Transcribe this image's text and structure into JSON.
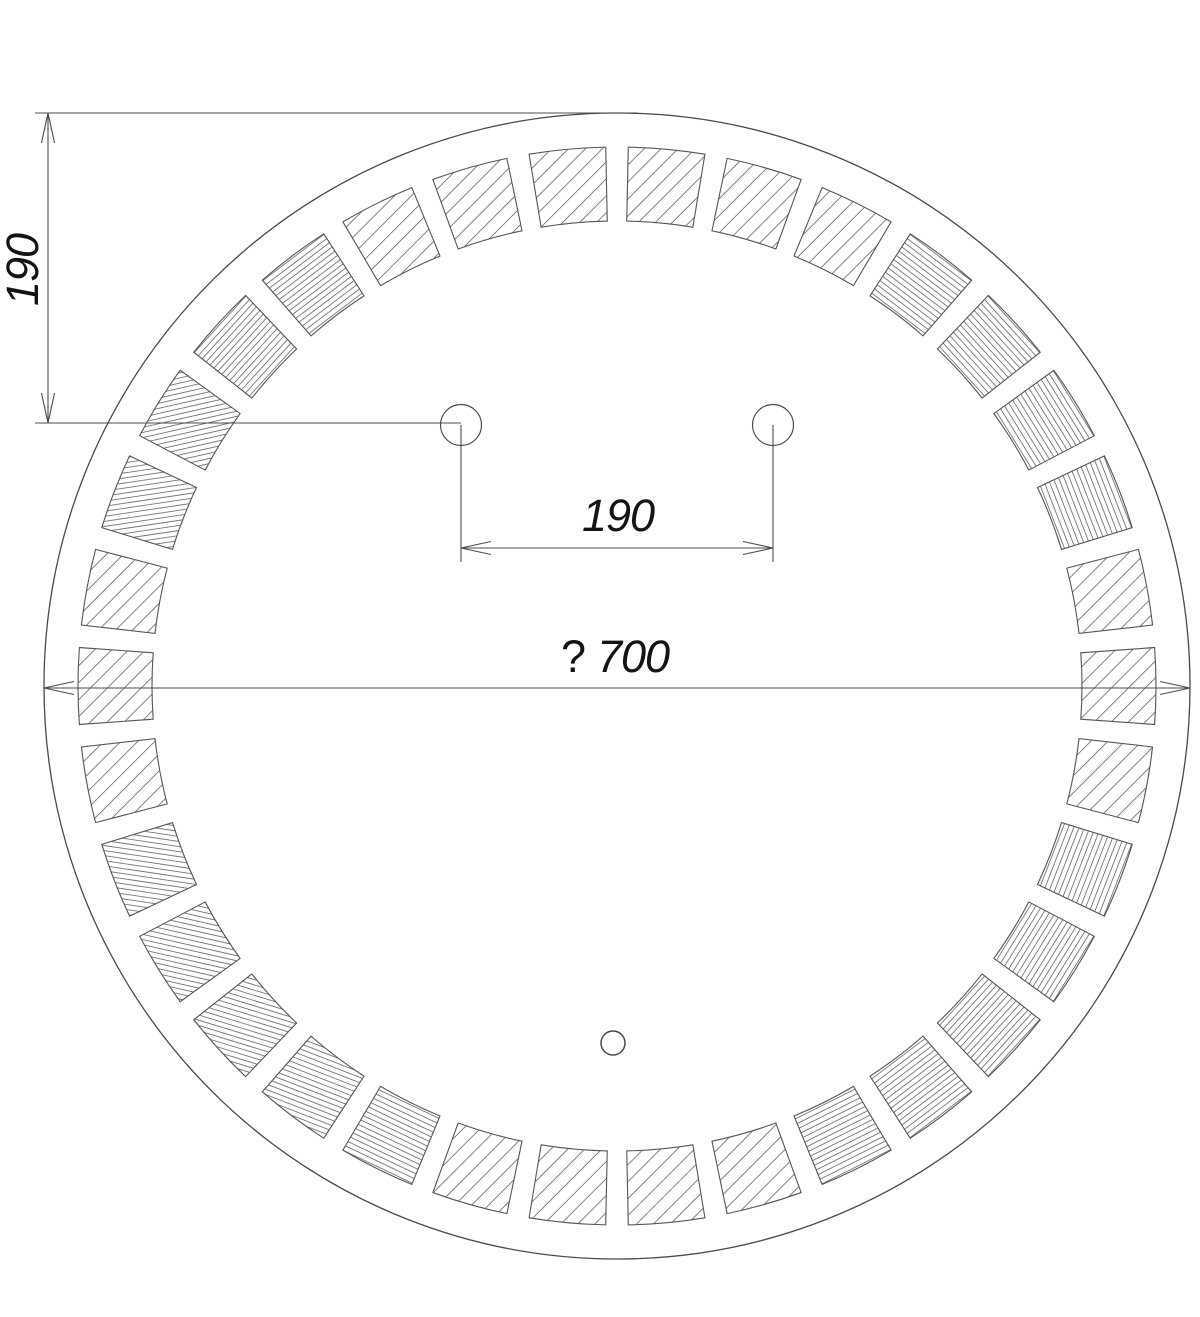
{
  "title": "Round mirror with LED segment ring - dimensioned technical drawing",
  "canvas": {
    "width": 1200,
    "height": 1317,
    "background": "#ffffff"
  },
  "style": {
    "line_color": "#4a4a4a",
    "segment_line_color": "#555555",
    "hatch_color": "#757575",
    "dim_line_color": "#4d4d4d",
    "text_color": "#141414",
    "outline_width": 1.3,
    "segment_outline_width": 1.1,
    "hatch_width": 0.9,
    "dim_width": 1.1,
    "arrow_length": 30,
    "arrow_half_width": 6.5
  },
  "mirror": {
    "outer_circle": {
      "cx": 617,
      "cy": 686,
      "r": 573
    },
    "led_band": {
      "r_outer": 539,
      "r_inner": 465,
      "segment_count": 34,
      "gap_deg": 2.4,
      "first_gap_deg": 90,
      "hatch_dense_spacing": 5,
      "hatch_coarse_spacing": 12
    },
    "mount_holes": [
      {
        "cx": 461,
        "cy": 425,
        "r": 20.5
      },
      {
        "cx": 773,
        "cy": 425,
        "r": 20.5
      }
    ],
    "sensor_hole": {
      "cx": 613,
      "cy": 1043,
      "r": 12
    }
  },
  "dimensions": {
    "vertical_offset": {
      "label": "190",
      "line_x": 48,
      "y1": 113,
      "y2": 423,
      "ext_top": {
        "y": 113,
        "x1": 35,
        "x2": 638
      },
      "ext_bottom": {
        "y": 423,
        "x1": 35,
        "x2": 461
      },
      "text": {
        "x": 38,
        "y": 270
      }
    },
    "hole_spacing": {
      "label": "190",
      "line_y": 548,
      "x1": 461,
      "x2": 773,
      "stem_top": 425,
      "stem_bottom": 562,
      "text": {
        "x": 618,
        "y": 531
      }
    },
    "diameter": {
      "prefix": "?",
      "label": "700",
      "line_y": 688,
      "x1": 44,
      "x2": 1190,
      "text": {
        "prefix_x": 561,
        "value_x": 597,
        "y": 672
      }
    }
  }
}
